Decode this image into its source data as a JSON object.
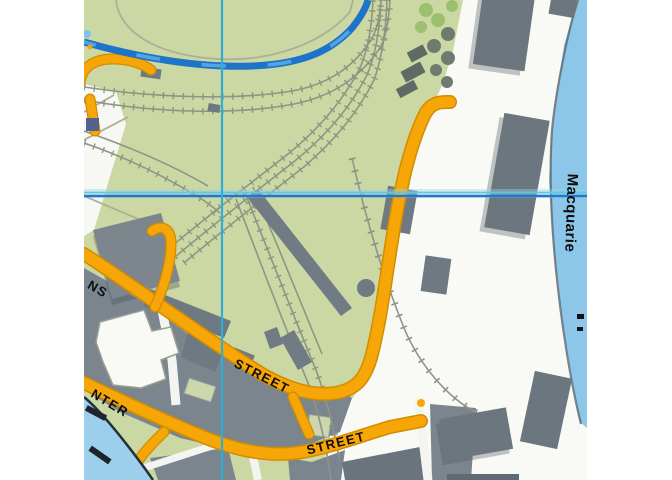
{
  "map": {
    "kind": "street-map-crop",
    "street_labels": [
      {
        "text": "NS"
      },
      {
        "text": "STREET"
      },
      {
        "text": "NTER"
      },
      {
        "text": "STREET"
      }
    ],
    "place_labels": [
      {
        "text": "Macquarie"
      }
    ],
    "crosshair": {
      "x": 222,
      "y": 195
    },
    "palette": {
      "parkland_green": "#cbd8a3",
      "paving_white": "#f7f8f4",
      "road_orange": "#f6a606",
      "road_casing_orange": "#d18c00",
      "building_gray": "#6e7982",
      "city_block_gray": "#7b858d",
      "wharf_building_gray": "#6b767e",
      "water_blue": "#8cc6e8",
      "stream_blue": "#1e74c8",
      "railway_gray": "#8f9485",
      "gridline_cyan": "#2fadd6",
      "gridline_blue": "#2277c8",
      "label_black": "#111111"
    }
  }
}
